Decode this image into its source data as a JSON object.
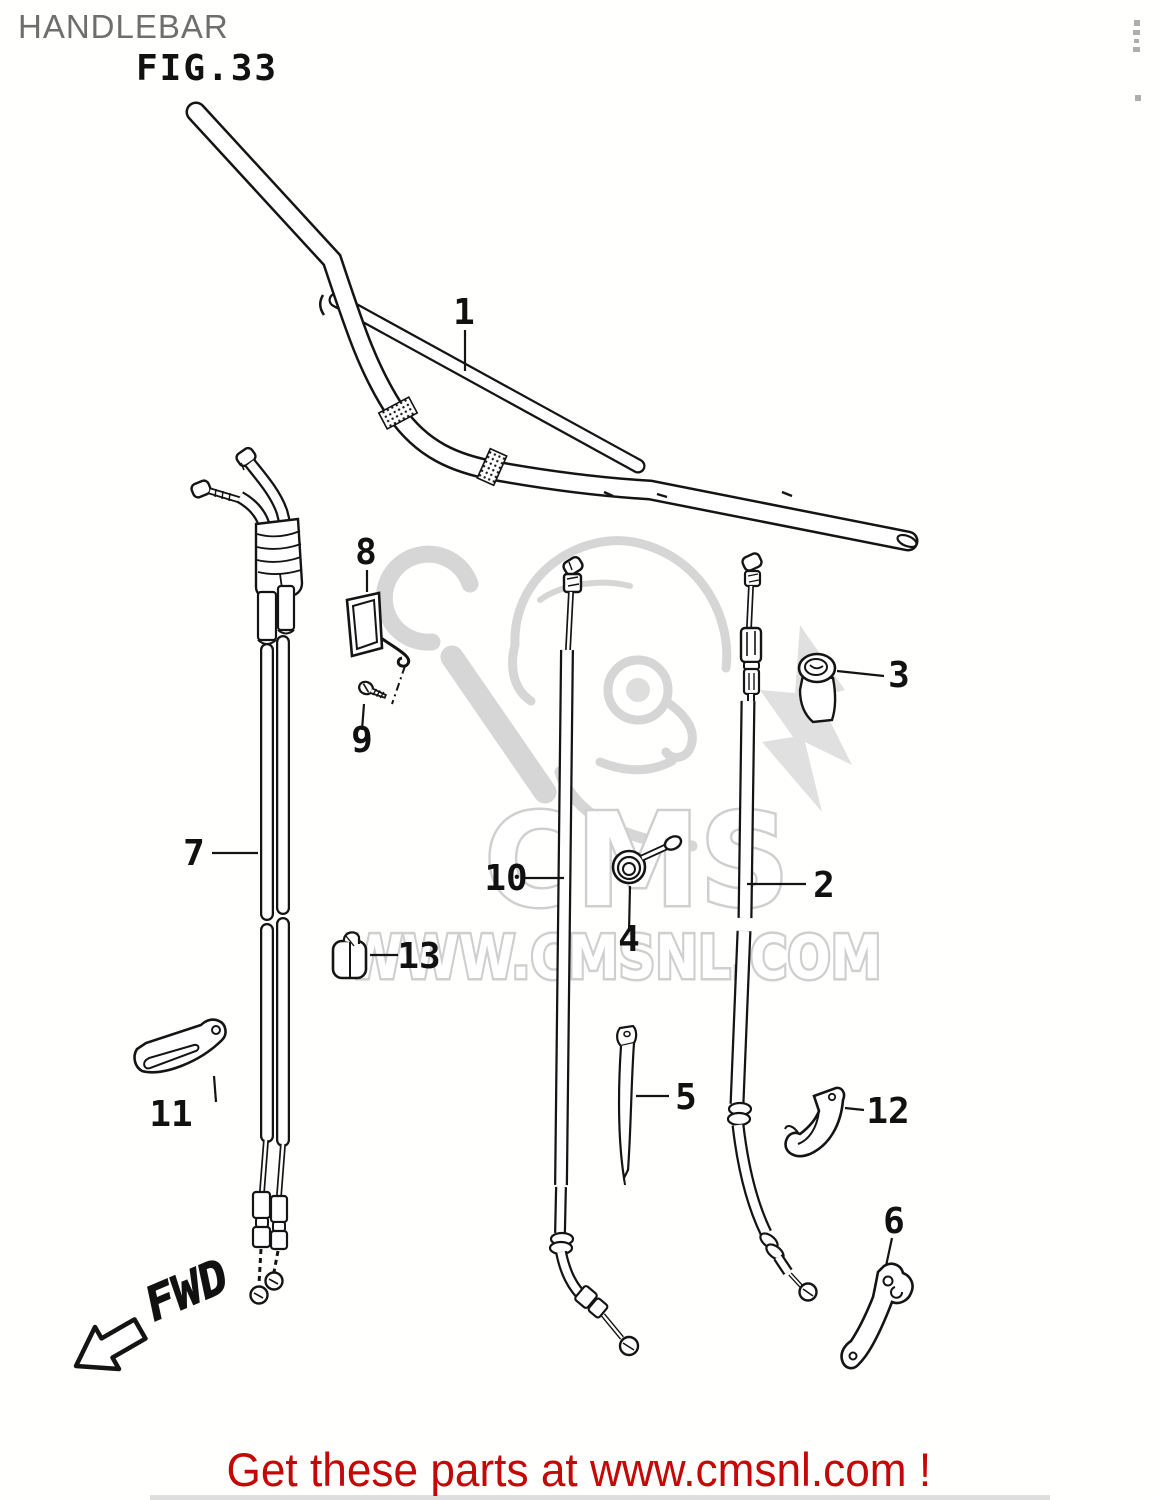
{
  "header": {
    "title": "HANDLEBAR",
    "figure_label": "FIG.33"
  },
  "watermark": {
    "brand": "CMS",
    "url_text": "WWW.CMSNL.COM"
  },
  "footer": {
    "message": "Get these parts at www.cmsnl.com !"
  },
  "diagram": {
    "direction_label": "FWD",
    "parts": [
      {
        "num": "1",
        "name": "handlebar"
      },
      {
        "num": "2",
        "name": "clutch cable"
      },
      {
        "num": "3",
        "name": "cap"
      },
      {
        "num": "4",
        "name": "spring"
      },
      {
        "num": "5",
        "name": "strap"
      },
      {
        "num": "6",
        "name": "lever bracket"
      },
      {
        "num": "7",
        "name": "throttle cable pair"
      },
      {
        "num": "8",
        "name": "cable clamp"
      },
      {
        "num": "9",
        "name": "screw"
      },
      {
        "num": "10",
        "name": "cable"
      },
      {
        "num": "11",
        "name": "lever"
      },
      {
        "num": "12",
        "name": "cable guide"
      },
      {
        "num": "13",
        "name": "clip"
      }
    ]
  },
  "colors": {
    "line": "#141414",
    "accent_red": "#c40808",
    "watermark_gray": "#cfcfcf",
    "title_gray": "#6e6e6e"
  }
}
